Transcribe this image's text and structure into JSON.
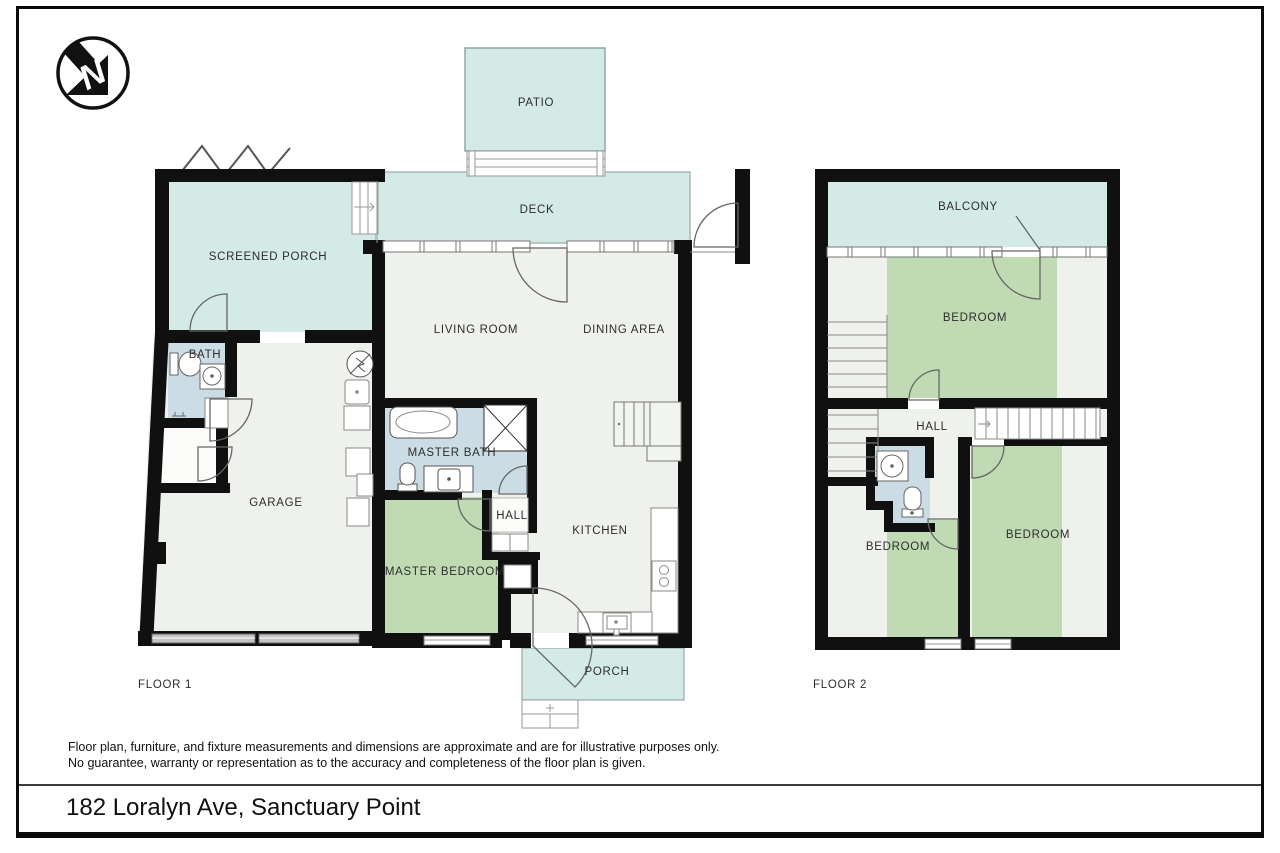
{
  "page": {
    "disclaimer_line1": "Floor plan, furniture, and fixture measurements and dimensions are approximate and are for illustrative purposes only.",
    "disclaimer_line2": "No guarantee, warranty or representation as to the accuracy and completeness of the floor plan is given.",
    "address_title": "182 Loralyn Ave, Sanctuary Point"
  },
  "icons": {
    "north_arrow": "north-arrow-compass"
  },
  "colors": {
    "outdoor_teal": "#d3eae6",
    "bedroom_green": "#c0dbb3",
    "bath_blue": "#cbdce4",
    "room_offwhite": "#eff1ec",
    "wall_black": "#101010",
    "fixture_gray": "#777777",
    "garage_door_gray": "#c4c4c4"
  },
  "floor1": {
    "label": "FLOOR 1",
    "rooms": {
      "patio": "PATIO",
      "deck": "DECK",
      "screened_porch": "SCREENED PORCH",
      "living_room": "LIVING ROOM",
      "dining_area": "DINING AREA",
      "bath": "BATH",
      "garage": "GARAGE",
      "master_bath": "MASTER BATH",
      "master_bedroom": "MASTER BEDROOM",
      "hall": "HALL",
      "kitchen": "KITCHEN",
      "porch": "PORCH"
    }
  },
  "floor2": {
    "label": "FLOOR 2",
    "rooms": {
      "balcony": "BALCONY",
      "bedroom_top": "BEDROOM",
      "hall": "HALL",
      "bedroom_left": "BEDROOM",
      "bedroom_right": "BEDROOM"
    }
  }
}
